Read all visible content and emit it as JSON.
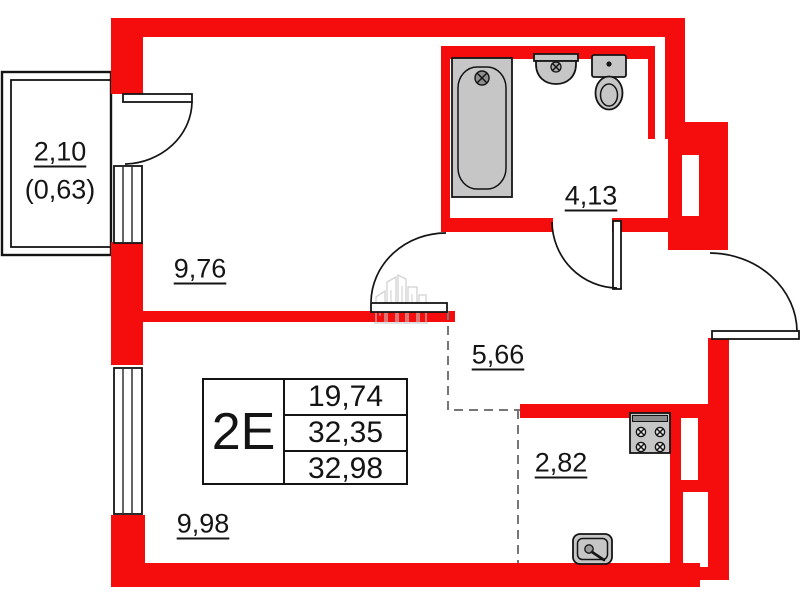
{
  "title": "apartment-floor-plan",
  "unit": {
    "type_label": "2E",
    "area_rows": [
      "19,74",
      "32,35",
      "32,98"
    ]
  },
  "rooms": {
    "balcony": {
      "area": "2,10",
      "area_reduced": "(0,63)"
    },
    "bedroom": {
      "area": "9,76"
    },
    "bathroom": {
      "area": "4,13"
    },
    "hallway": {
      "area": "5,66"
    },
    "kitchen": {
      "area": "2,82"
    },
    "living_room": {
      "area": "9,98"
    }
  },
  "fixtures": [
    "bathtub",
    "washbasin",
    "toilet",
    "stove",
    "kitchen-sink"
  ],
  "colors": {
    "wall_red": "#f50c0c",
    "fixture_gray": "#c6c6c6",
    "line_black": "#141414",
    "dash_gray": "#767676",
    "watermark_gray": "#c9c9c9"
  }
}
